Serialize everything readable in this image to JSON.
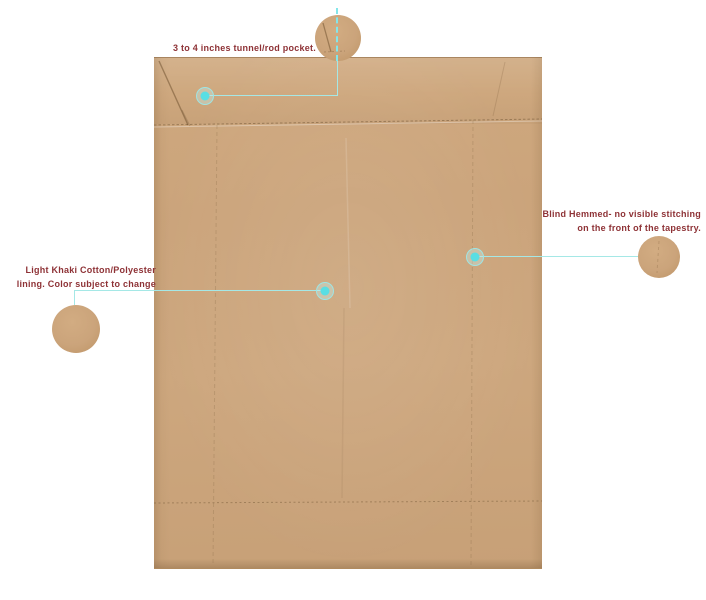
{
  "page": {
    "background": "#ffffff"
  },
  "colors": {
    "page_bg": "#ffffff",
    "fabric": "#cba47b",
    "fabric_light": "#d2ac82",
    "fabric_dark": "#b98f60",
    "label_text": "#8e3236",
    "marker_dot": "#59dee3",
    "marker_ring": "#9fe5e4",
    "leader_line": "#a5e8e6",
    "stitch_line": "#7d6038"
  },
  "annotations": {
    "rod_pocket": {
      "label": "3 to 4 inches tunnel/rod pocket."
    },
    "blind_hem": {
      "label_line1": "Blind Hemmed- no visible stitching",
      "label_line2": "on the front of the tapestry."
    },
    "lining": {
      "label_line1": "Light Khaki Cotton/Polyester",
      "label_line2": "lining. Color subject to change"
    }
  }
}
